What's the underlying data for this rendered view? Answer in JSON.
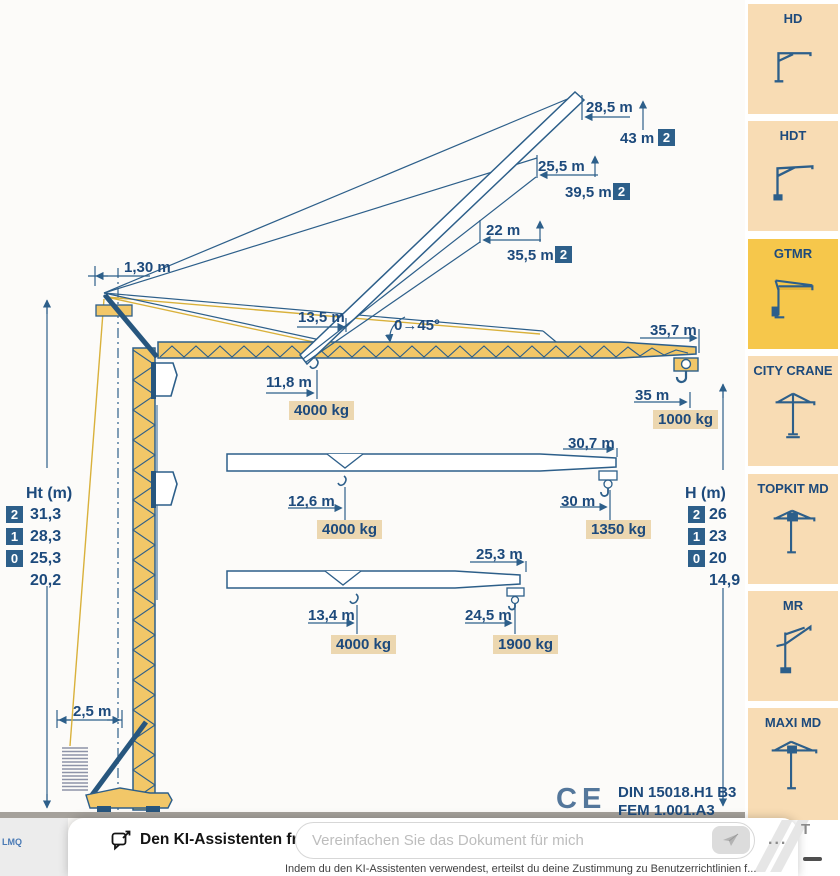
{
  "diagram": {
    "mast_head_offset": "1,30 m",
    "luff_range": "0→45°",
    "inner_radius": "13,5 m",
    "raised_configs": [
      {
        "radius": "28,5 m",
        "height": "43 m",
        "badge": "2"
      },
      {
        "radius": "25,5 m",
        "height": "39,5 m",
        "badge": "2"
      },
      {
        "radius": "22 m",
        "height": "35,5 m",
        "badge": "2"
      }
    ],
    "jibs": [
      {
        "length": "35,7 m",
        "mid_radius": "11,8 m",
        "mid_load": "4000 kg",
        "tip_radius": "35 m",
        "tip_load": "1000 kg"
      },
      {
        "length": "30,7 m",
        "mid_radius": "12,6 m",
        "mid_load": "4000 kg",
        "tip_radius": "30 m",
        "tip_load": "1350 kg"
      },
      {
        "length": "25,3 m",
        "mid_radius": "13,4 m",
        "mid_load": "4000 kg",
        "tip_radius": "24,5 m",
        "tip_load": "1900 kg"
      }
    ],
    "ht_table": {
      "title": "Ht (m)",
      "rows": [
        {
          "badge": "2",
          "value": "31,3"
        },
        {
          "badge": "1",
          "value": "28,3"
        },
        {
          "badge": "0",
          "value": "25,3"
        },
        {
          "value": "20,2"
        }
      ]
    },
    "h_table": {
      "title": "H (m)",
      "rows": [
        {
          "badge": "2",
          "value": "26"
        },
        {
          "badge": "1",
          "value": "23"
        },
        {
          "badge": "0",
          "value": "20"
        },
        {
          "value": "14,9"
        }
      ]
    },
    "base_track": "2,5 m",
    "ce_mark": "CE",
    "standard_1": "DIN 15018.H1 B3",
    "standard_2": "FEM 1.001.A3",
    "doc_code": "LMQ"
  },
  "sidebar": {
    "items": [
      {
        "label": "HD",
        "active": false
      },
      {
        "label": "HDT",
        "active": false
      },
      {
        "label": "GTMR",
        "active": true
      },
      {
        "label": "CITY CRANE",
        "active": false
      },
      {
        "label": "TOPKIT MD",
        "active": false
      },
      {
        "label": "MR",
        "active": false
      },
      {
        "label": "MAXI MD",
        "active": false
      }
    ]
  },
  "assistant": {
    "title": "Den KI-Assistenten fragen",
    "placeholder": "Vereinfachen Sie das Dokument für mich",
    "more": "...",
    "disclaimer": "Indem du den KI-Assistenten verwendest, erteilst du deine Zustimmung zu Benutzerrichtlinien f..."
  },
  "artifacts": {
    "corner_glyph": "T"
  },
  "colors": {
    "line_blue": "#2d5f8a",
    "text_blue": "#1d4a7c",
    "crane_yellow": "#f2c768",
    "badge_bg": "#2d5f8a",
    "label_tan": "#ecd7b0",
    "sidebar_peach": "#f8dcb4",
    "active_yellow": "#f6c74b",
    "ground_gray": "#a5a19b"
  }
}
